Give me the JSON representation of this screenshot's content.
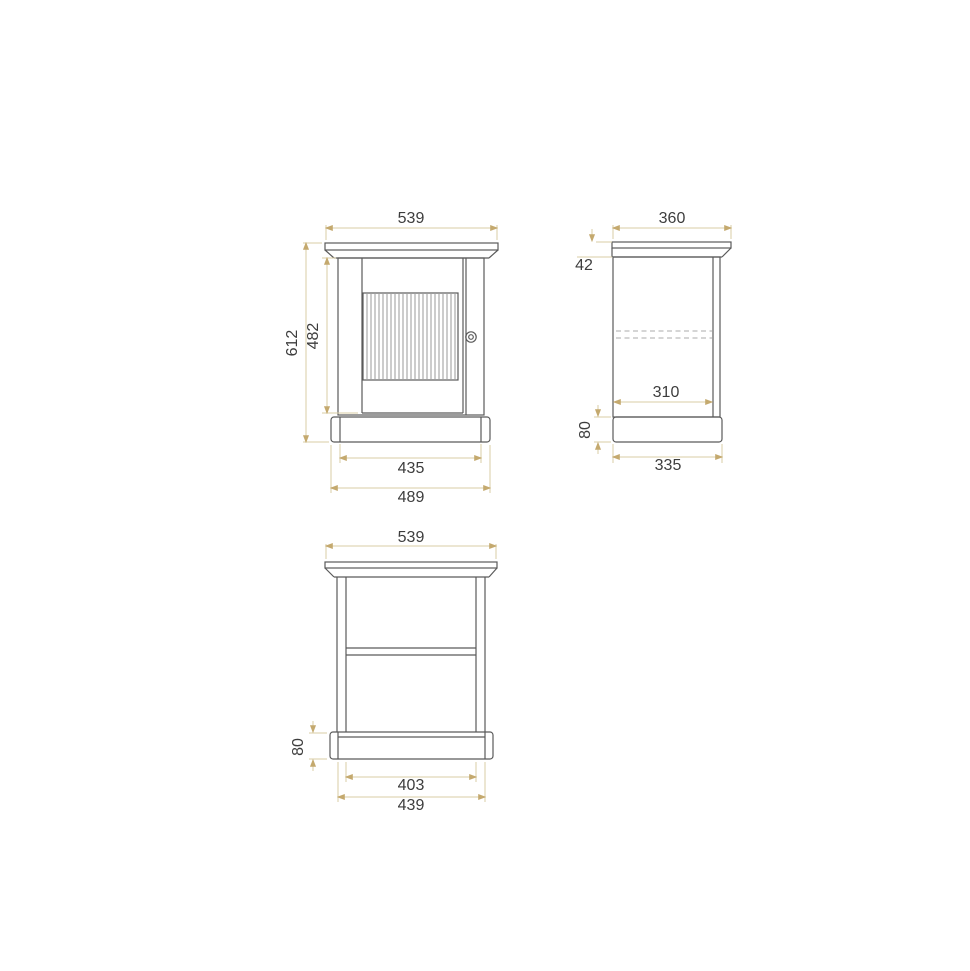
{
  "drawing": {
    "type": "furniture-dimension-drawing",
    "subject": "single-door cabinet, three orthographic views",
    "colors": {
      "background": "#ffffff",
      "object_line": "#5a5a5a",
      "slat_line": "#8f8f8f",
      "hidden_line": "#ababab",
      "dim_line": "#d8cda6",
      "dim_arrow": "#c4a96e",
      "dim_text": "#3d3d3d"
    },
    "views": {
      "front": {
        "label": "front-view",
        "dims": {
          "top_width": "539",
          "overall_height": "612",
          "door_height": "482",
          "plinth_inner_width": "435",
          "plinth_width": "489"
        }
      },
      "side": {
        "label": "side-view",
        "dims": {
          "top_depth": "360",
          "crown_height": "42",
          "inner_depth": "310",
          "plinth_height": "80",
          "plinth_depth": "335"
        }
      },
      "rear": {
        "label": "rear-view",
        "dims": {
          "top_width": "539",
          "plinth_height": "80",
          "inner_width": "403",
          "plinth_width": "439"
        }
      }
    }
  }
}
